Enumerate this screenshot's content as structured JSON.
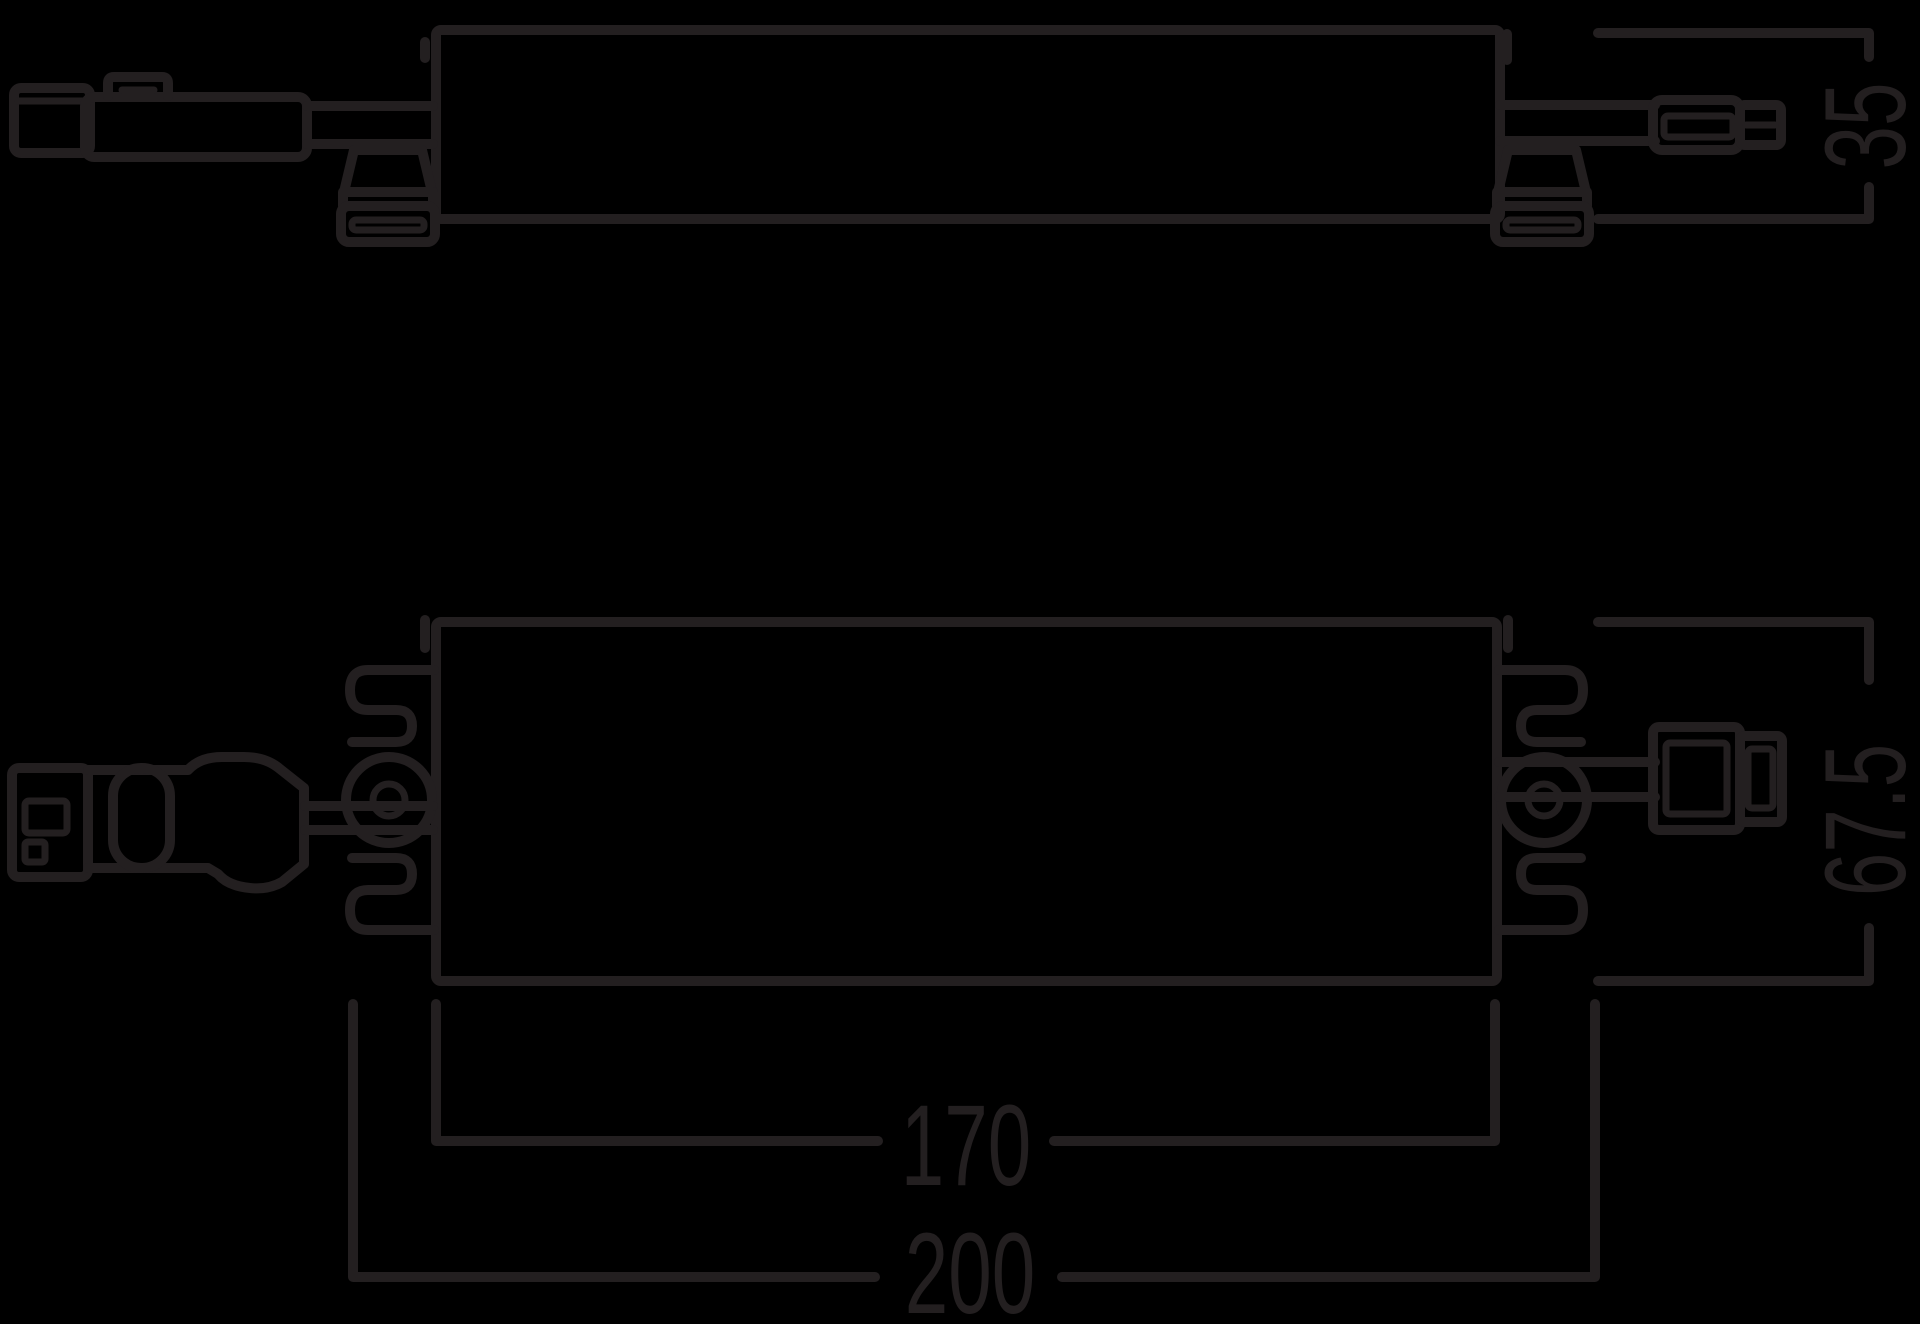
{
  "drawing": {
    "type": "technical-dimension-drawing",
    "views": {
      "side_view": "driver side profile with inline cable connectors and mounting clips",
      "top_view": "driver top profile with spring clips, input plug and output plug"
    },
    "dimensions": {
      "height": {
        "label": "35"
      },
      "depth": {
        "label": "67.5"
      },
      "body_length": {
        "label": "170"
      },
      "overall_length": {
        "label": "200"
      }
    },
    "colors": {
      "background": "#000000",
      "line": "#231f20"
    }
  }
}
